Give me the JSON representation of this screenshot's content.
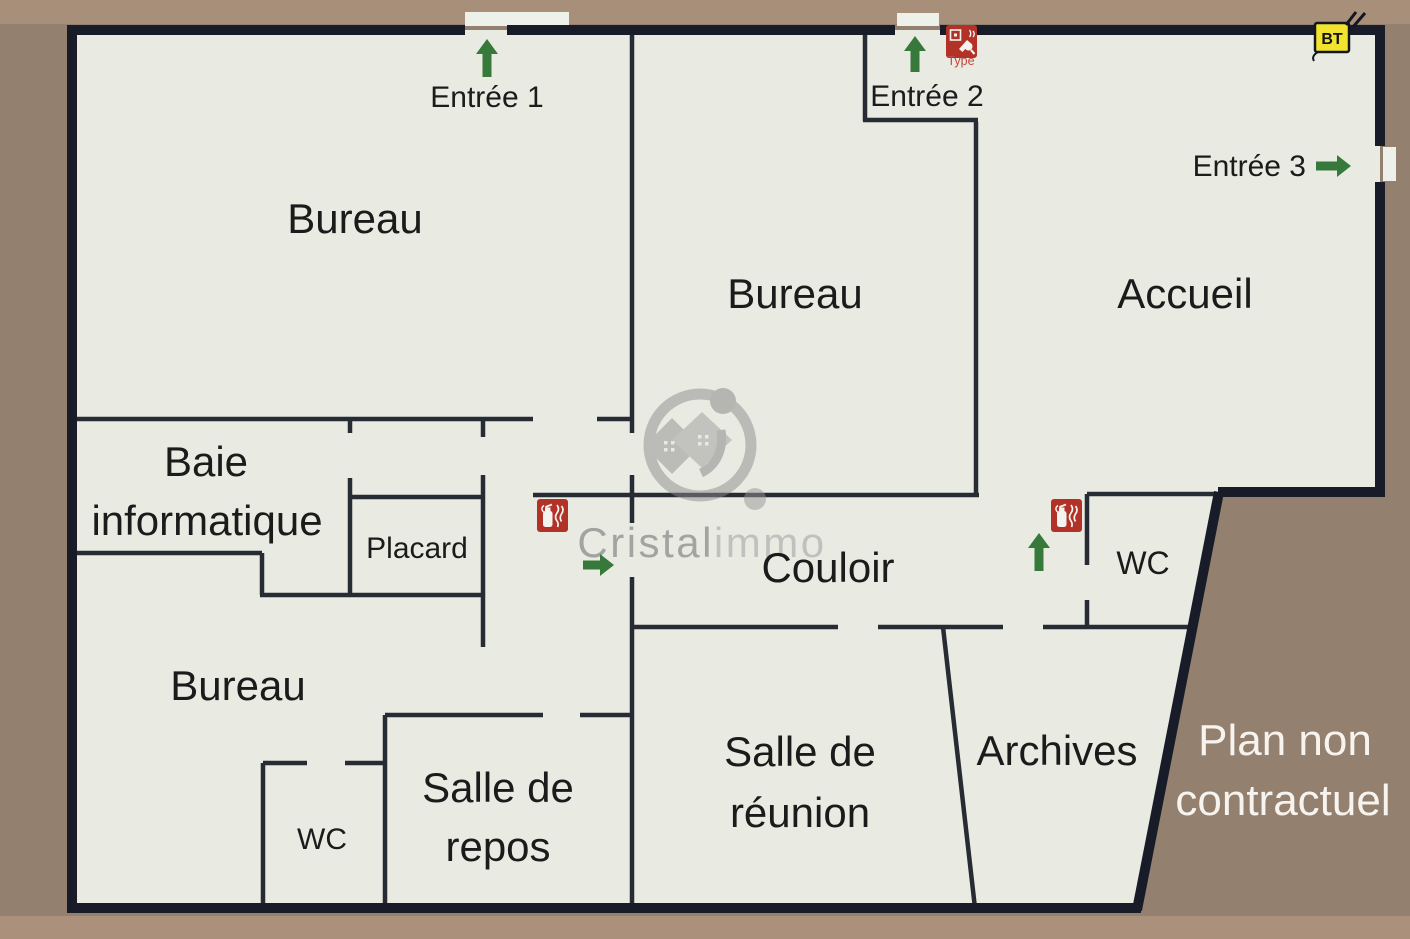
{
  "plan": {
    "rooms": {
      "bureau_top_left": {
        "label": "Bureau"
      },
      "bureau_middle": {
        "label": "Bureau"
      },
      "accueil": {
        "label": "Accueil"
      },
      "baie_informatique": {
        "line1": "Baie",
        "line2": "informatique"
      },
      "placard": {
        "label": "Placard"
      },
      "couloir": {
        "label": "Couloir"
      },
      "wc_right": {
        "label": "WC"
      },
      "bureau_bottom_left": {
        "label": "Bureau"
      },
      "wc_bottom_left": {
        "label": "WC"
      },
      "salle_de_repos": {
        "line1": "Salle de",
        "line2": "repos"
      },
      "salle_de_reunion": {
        "line1": "Salle de",
        "line2": "réunion"
      },
      "archives": {
        "label": "Archives"
      }
    },
    "entrances": {
      "entree1": {
        "label": "Entrée 1"
      },
      "entree2": {
        "label": "Entrée 2"
      },
      "entree3": {
        "label": "Entrée 3"
      }
    },
    "icons": {
      "fire_extinguisher": "fire-extinguisher-icon",
      "fire_alarm_call_point": "fire-alarm-call-point-icon",
      "call_point_caption": "Type",
      "electrical_panel": "bt-electrical-panel-icon",
      "electrical_panel_label": "BT",
      "entrance_arrow": "green-arrow-icon"
    },
    "watermark": {
      "brand_part1": "Cristal",
      "brand_part2": "immo"
    },
    "disclaimer": {
      "line1": "Plan non",
      "line2": "contractuel"
    }
  },
  "colors": {
    "background": "#93806f",
    "background_light": "#bb9d85",
    "floor": "#e9ebe3",
    "outer_wall": "#181c29",
    "inner_wall": "#272b34",
    "label_text": "#1b1b1b",
    "arrow_green": "#36793a",
    "icon_red": "#b23227",
    "icon_white": "#f3f4f0",
    "icon_caption_red": "#c4463d",
    "bt_yellow": "#f2e32e",
    "watermark_gray": "#8c8c8c",
    "watermark_light": "#aeaeae",
    "disclaimer_white": "#f7f3ee",
    "exterior_mark_white": "#eef0ea"
  }
}
